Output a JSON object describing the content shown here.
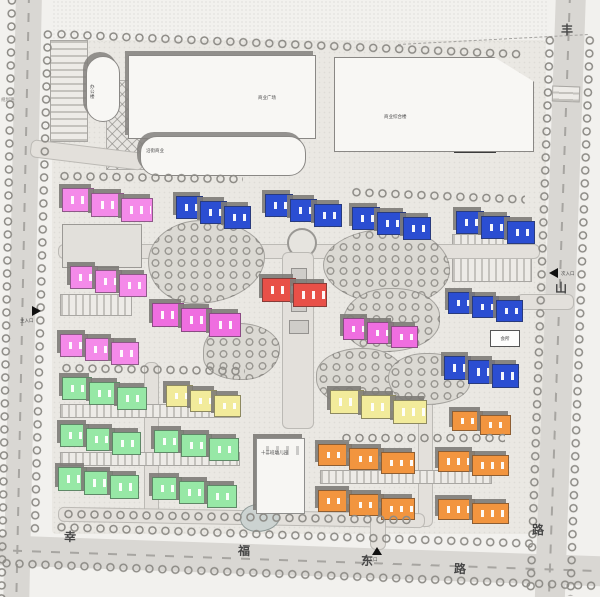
{
  "page": {
    "type": "residential-site-plan"
  },
  "roads": {
    "south": {
      "name": "幸福东路",
      "chars": [
        "幸",
        "福",
        "东",
        "路"
      ]
    },
    "east": {
      "name": "丰山路",
      "chars": [
        "丰",
        "山",
        "路"
      ]
    },
    "west": {
      "label": "规划路"
    }
  },
  "entrances": {
    "west": "主入口",
    "east": "次入口",
    "south": "次入口"
  },
  "labels": {
    "plaza": "商业广场",
    "mall": "商业综合楼",
    "annex": "沿街商业",
    "office": "办公楼",
    "club": "会所",
    "kindergarten": "十二班幼儿园"
  },
  "colors": {
    "blue": "#2b4ed2",
    "pink": "#f48ae9",
    "magenta": "#ef6ee0",
    "red": "#e85048",
    "green": "#97e8a6",
    "yellow": "#f2eb9b",
    "orange": "#f2953f",
    "white": "#f7f6f3"
  },
  "building_groups": [
    {
      "group": "blue",
      "count": 6
    },
    {
      "group": "pink",
      "count": 3
    },
    {
      "group": "magenta",
      "count": 2
    },
    {
      "group": "red",
      "count": 1
    },
    {
      "group": "green",
      "count": 5
    },
    {
      "group": "yellow",
      "count": 2
    },
    {
      "group": "orange",
      "count": 5
    },
    {
      "group": "white",
      "count": 1
    }
  ],
  "buildings": [
    {
      "id": "P1",
      "color": "pink",
      "x": 62,
      "y": 188,
      "w": 88,
      "segh": 22,
      "segs": 3,
      "step": 5
    },
    {
      "id": "B1",
      "color": "blue",
      "x": 176,
      "y": 196,
      "w": 72,
      "segh": 21,
      "segs": 3,
      "step": 5
    },
    {
      "id": "B2",
      "color": "blue",
      "x": 265,
      "y": 194,
      "w": 74,
      "segh": 21,
      "segs": 3,
      "step": 5
    },
    {
      "id": "B3",
      "color": "blue",
      "x": 352,
      "y": 207,
      "w": 76,
      "segh": 21,
      "segs": 3,
      "step": 5
    },
    {
      "id": "B4",
      "color": "blue",
      "x": 456,
      "y": 211,
      "w": 76,
      "segh": 21,
      "segs": 3,
      "step": 5
    },
    {
      "id": "P2",
      "color": "pink",
      "x": 70,
      "y": 266,
      "w": 74,
      "segh": 21,
      "segs": 3,
      "step": 4
    },
    {
      "id": "B5",
      "color": "blue",
      "x": 448,
      "y": 292,
      "w": 72,
      "segh": 20,
      "segs": 3,
      "step": 4
    },
    {
      "id": "R1",
      "color": "red",
      "x": 262,
      "y": 278,
      "w": 62,
      "segh": 22,
      "segs": 2,
      "step": 5
    },
    {
      "id": "P3",
      "color": "magenta",
      "x": 152,
      "y": 303,
      "w": 86,
      "segh": 22,
      "segs": 3,
      "step": 5
    },
    {
      "id": "P4",
      "color": "magenta",
      "x": 343,
      "y": 318,
      "w": 72,
      "segh": 20,
      "segs": 3,
      "step": 4
    },
    {
      "id": "P5",
      "color": "pink",
      "x": 60,
      "y": 334,
      "w": 76,
      "segh": 21,
      "segs": 3,
      "step": 4
    },
    {
      "id": "B6",
      "color": "blue",
      "x": 444,
      "y": 356,
      "w": 72,
      "segh": 22,
      "segs": 3,
      "step": 4
    },
    {
      "id": "G1",
      "color": "green",
      "x": 62,
      "y": 377,
      "w": 82,
      "segh": 21,
      "segs": 3,
      "step": 5
    },
    {
      "id": "Y1",
      "color": "yellow",
      "x": 166,
      "y": 385,
      "w": 72,
      "segh": 20,
      "segs": 3,
      "step": 5
    },
    {
      "id": "Y2",
      "color": "yellow",
      "x": 330,
      "y": 390,
      "w": 94,
      "segh": 22,
      "segs": 3,
      "step": 5
    },
    {
      "id": "O1",
      "color": "orange",
      "x": 452,
      "y": 411,
      "w": 56,
      "segh": 18,
      "segs": 2,
      "step": 4
    },
    {
      "id": "G2",
      "color": "green",
      "x": 60,
      "y": 424,
      "w": 78,
      "segh": 21,
      "segs": 3,
      "step": 4
    },
    {
      "id": "G3",
      "color": "green",
      "x": 154,
      "y": 430,
      "w": 82,
      "segh": 21,
      "segs": 3,
      "step": 4
    },
    {
      "id": "O2",
      "color": "orange",
      "x": 318,
      "y": 444,
      "w": 94,
      "segh": 20,
      "segs": 3,
      "step": 4
    },
    {
      "id": "O3",
      "color": "orange",
      "x": 438,
      "y": 451,
      "w": 68,
      "segh": 19,
      "segs": 2,
      "step": 4
    },
    {
      "id": "G4",
      "color": "green",
      "x": 58,
      "y": 467,
      "w": 78,
      "segh": 22,
      "segs": 3,
      "step": 4
    },
    {
      "id": "G5",
      "color": "green",
      "x": 152,
      "y": 477,
      "w": 82,
      "segh": 21,
      "segs": 3,
      "step": 4
    },
    {
      "id": "O4",
      "color": "orange",
      "x": 318,
      "y": 490,
      "w": 94,
      "segh": 20,
      "segs": 3,
      "step": 4
    },
    {
      "id": "O5",
      "color": "orange",
      "x": 438,
      "y": 499,
      "w": 68,
      "segh": 19,
      "segs": 2,
      "step": 4
    },
    {
      "id": "KG",
      "color": "white",
      "x": 256,
      "y": 438,
      "w": 46,
      "segh": 74,
      "segs": 1,
      "step": 0
    }
  ]
}
